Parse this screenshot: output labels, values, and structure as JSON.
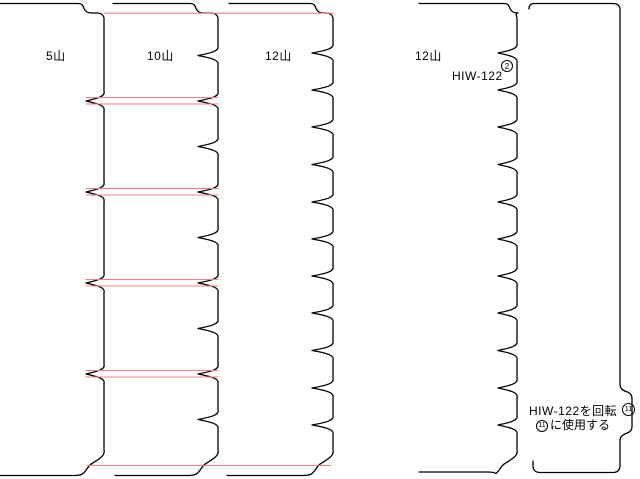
{
  "strips": [
    {
      "label": "5山",
      "teeth_count": 5
    },
    {
      "label": "10山",
      "teeth_count": 10
    },
    {
      "label": "12山",
      "teeth_count": 12
    },
    {
      "label": "12山",
      "teeth_count": 12
    }
  ],
  "annotations": {
    "part_number": "HIW-122",
    "part_number_badge": "2",
    "rotation_note_line1": "HIW-122を回転",
    "rotation_note_badge": "11",
    "rotation_note_line2": "に使用する",
    "corner_badge": "11"
  },
  "colors": {
    "outline": "#000000",
    "guide_line": "#f08080",
    "background": "#ffffff"
  }
}
